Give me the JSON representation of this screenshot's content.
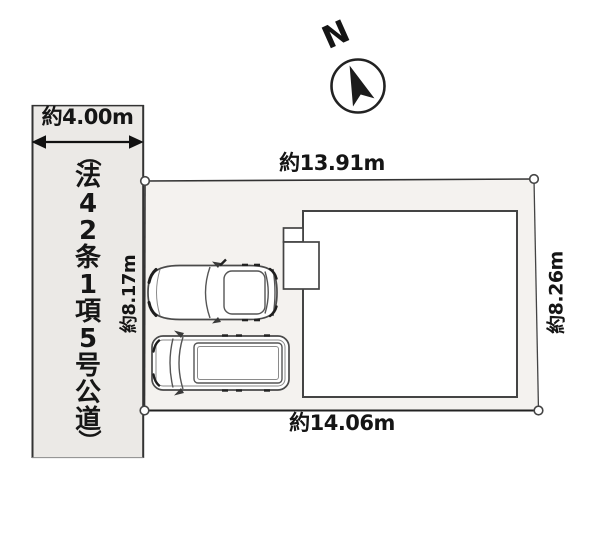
{
  "compass": {
    "label": "N"
  },
  "road": {
    "width_label": "約4.00m",
    "name": "（法42条1項5号公道）"
  },
  "plot": {
    "top_label": "約13.91m",
    "bottom_label": "約14.06m",
    "left_label": "約8.17m",
    "right_label": "約8.26m"
  },
  "colors": {
    "road_fill": "#ebe9e6",
    "plot_fill": "#f4f2ef",
    "building_fill": "#ffffff",
    "line": "#333333",
    "text": "#151515"
  }
}
